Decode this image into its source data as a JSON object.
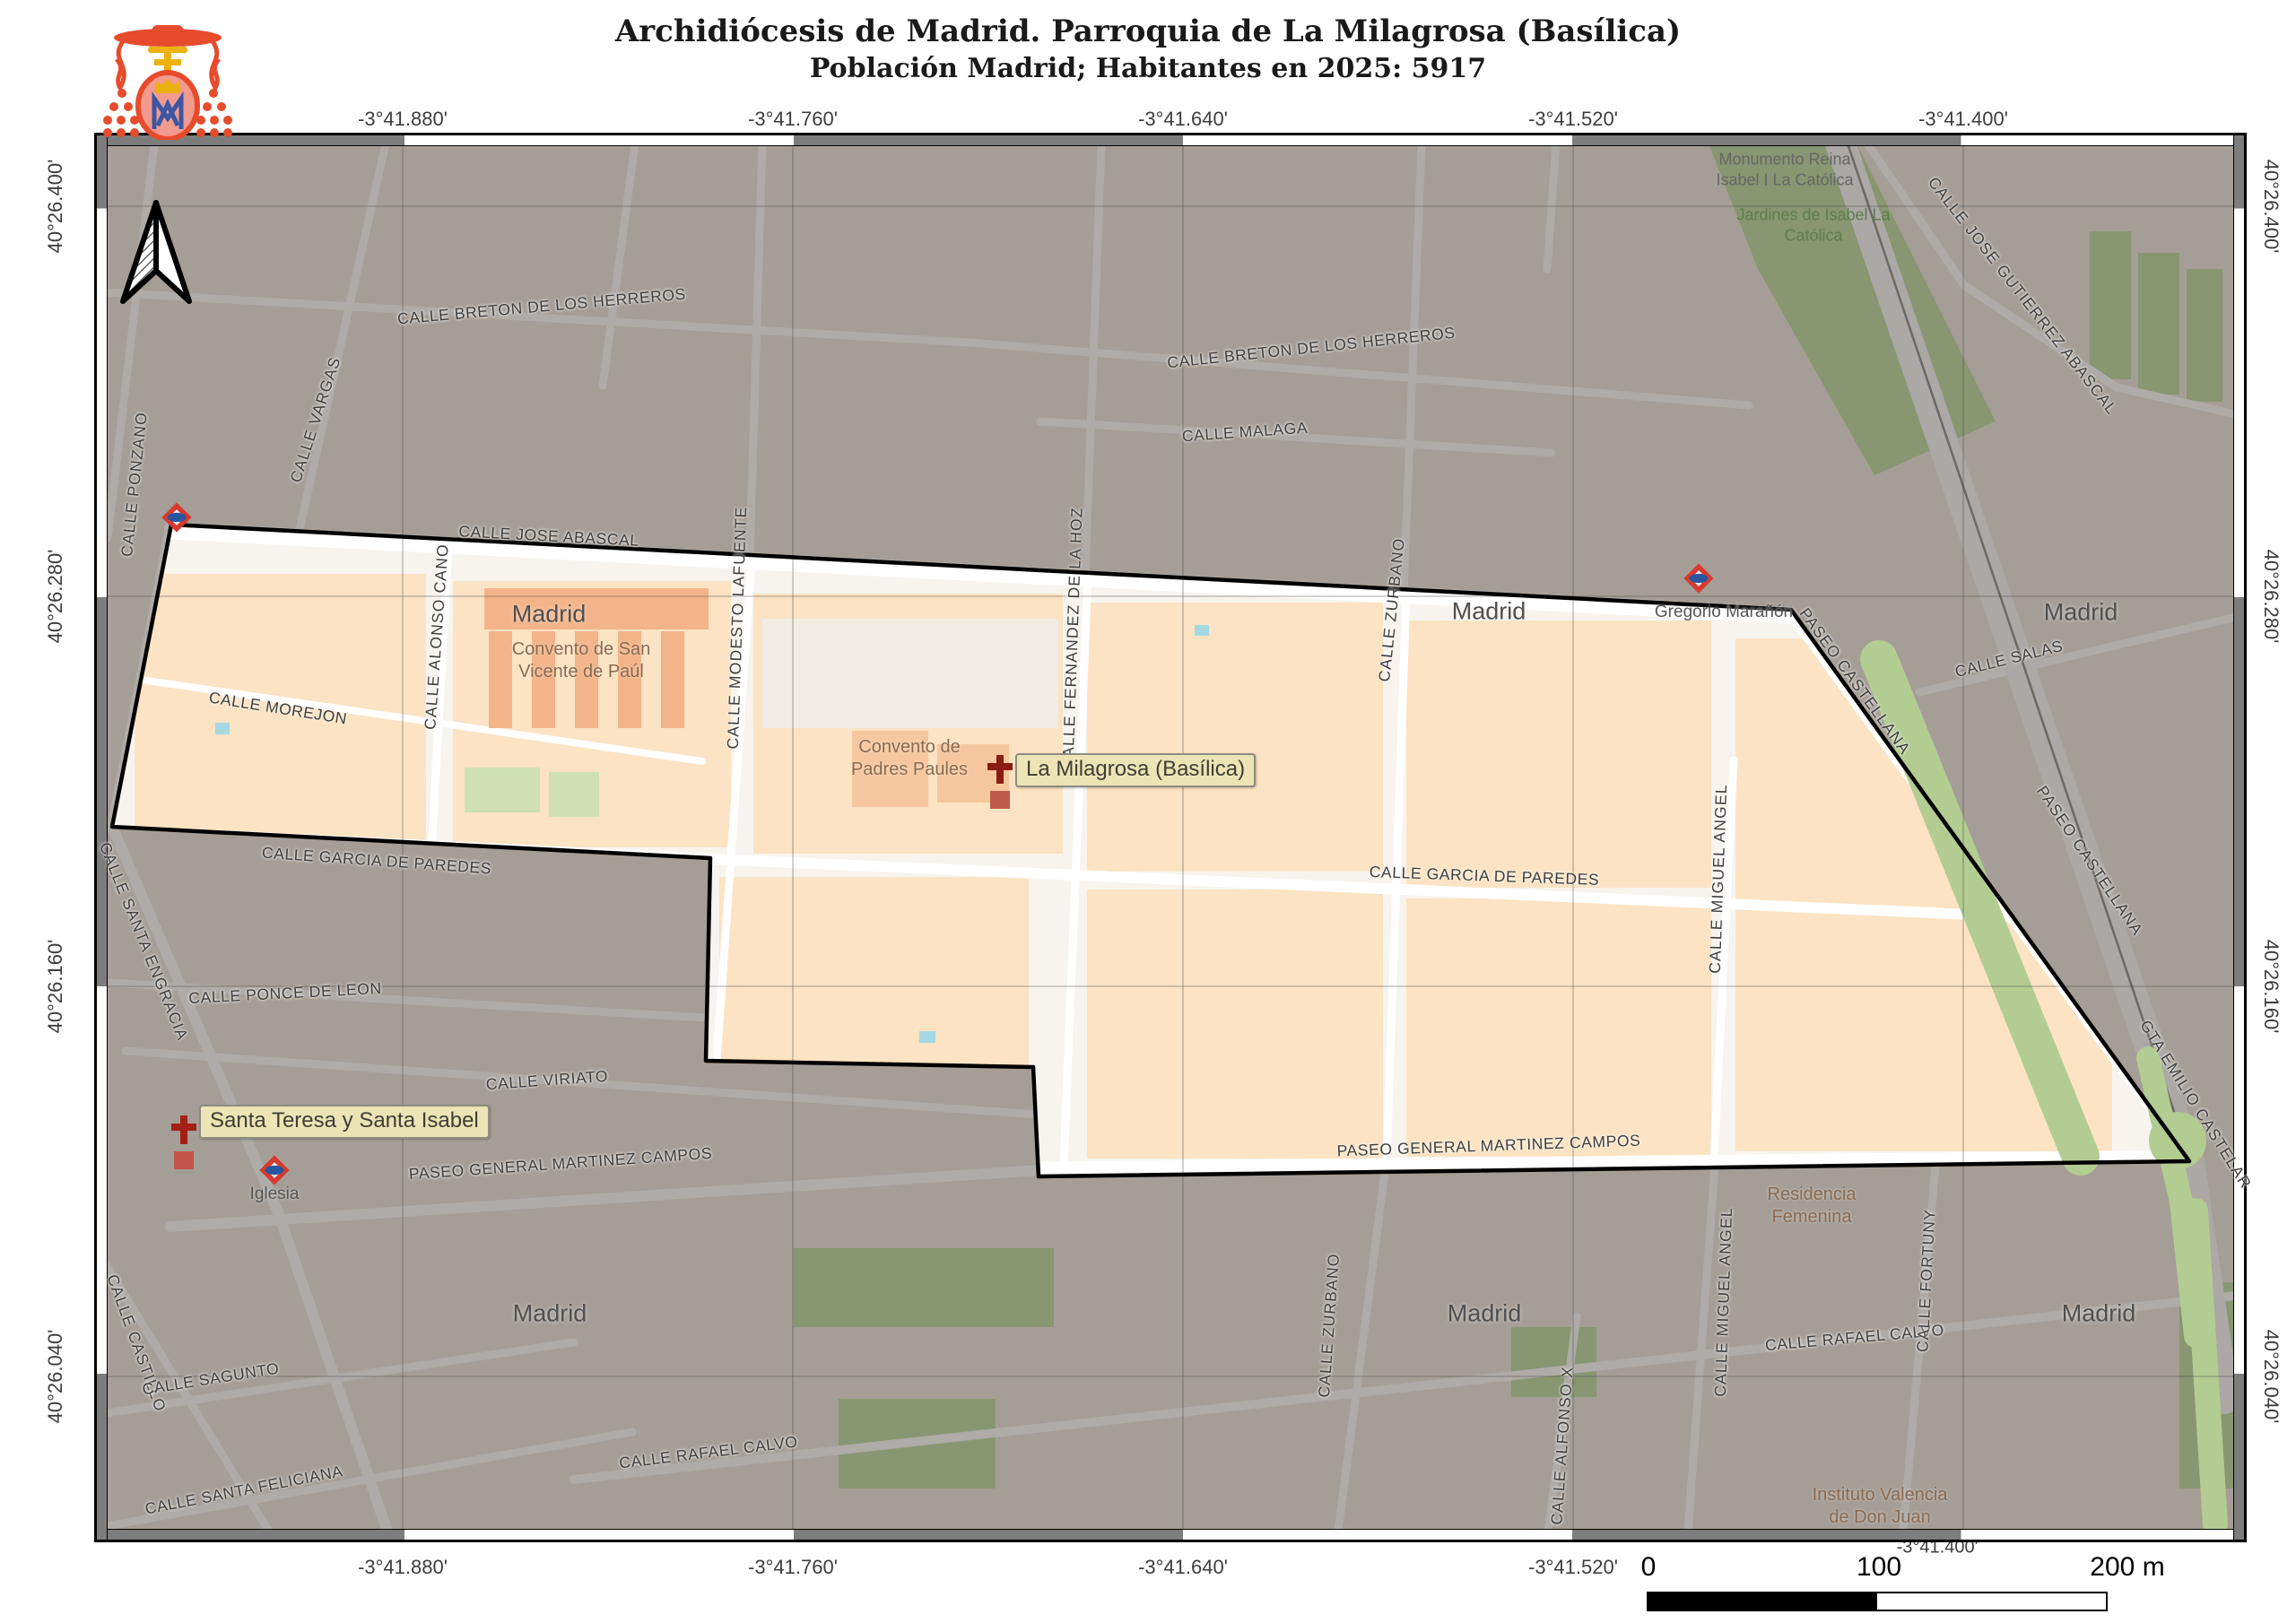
{
  "header": {
    "title": "Archidiócesis de Madrid. Parroquia de La Milagrosa (Basílica)",
    "subtitle": "Población Madrid; Habitantes en 2025: 5917"
  },
  "axes": {
    "top": [
      "-3°41.880'",
      "-3°41.760'",
      "-3°41.640'",
      "-3°41.520'",
      "-3°41.400'"
    ],
    "bottom": [
      "-3°41.880'",
      "-3°41.760'",
      "-3°41.640'",
      "-3°41.520'",
      "-3°41.400'"
    ],
    "left": [
      "40°26.400'",
      "40°26.280'",
      "40°26.160'",
      "40°26.040'"
    ],
    "right": [
      "40°26.400'",
      "40°26.280'",
      "40°26.160'",
      "40°26.040'"
    ]
  },
  "scalebar": {
    "zero": "0",
    "hundred": "100",
    "two_hundred": "200 m"
  },
  "streets": {
    "breton1": "CALLE BRETON DE LOS HERREROS",
    "breton2": "CALLE BRETON DE LOS HERREROS",
    "malaga": "CALLE MALAGA",
    "vargas": "CALLE VARGAS",
    "ponzano": "CALLE PONZANO",
    "jose_abascal": "CALLE JOSE ABASCAL",
    "gutierrez": "CALLE JOSE GUTIERREZ ABASCAL",
    "alonso": "CALLE ALONSO CANO",
    "modesto": "CALLE MODESTO LAFUENTE",
    "fernandez": "CALLE FERNANDEZ DE LA HOZ",
    "zurbano1": "CALLE ZURBANO",
    "zurbano2": "CALLE ZURBANO",
    "miguel1": "CALLE MIGUEL ANGEL",
    "miguel2": "CALLE MIGUEL ANGEL",
    "castellana1": "PASEO CASTELLANA",
    "castellana2": "PASEO CASTELLANA",
    "salas": "CALLE SALAS",
    "morejon": "CALLE MOREJON",
    "garcia1": "CALLE GARCIA DE PAREDES",
    "garcia2": "CALLE GARCIA DE PAREDES",
    "engracia": "CALLE SANTA ENGRACIA",
    "ponce": "CALLE PONCE DE LEON",
    "viriato": "CALLE VIRIATO",
    "martinez1": "PASEO GENERAL MARTINEZ CAMPOS",
    "martinez2": "PASEO GENERAL MARTINEZ CAMPOS",
    "castillo": "CALLE CASTILLO",
    "sagunto": "CALLE SAGUNTO",
    "feliciana": "CALLE SANTA FELICIANA",
    "rafael1": "CALLE RAFAEL CALVO",
    "rafael2": "CALLE RAFAEL CALVO",
    "alfonso_x": "CALLE ALFONSO X",
    "fortuny": "CALLE FORTUNY",
    "gta": "GTA EMILIO CASTELAR"
  },
  "places": {
    "madrid": "Madrid",
    "convento_sv": "Convento de San\nVicente de Paúl",
    "padres": "Convento de\nPadres Paules",
    "monumento": "Monumento Reina\nIsabel I La Católica",
    "jardines": "Jardines de Isabel La\nCatólica",
    "residencia": "Residencia\nFemenina",
    "instituto": "Instituto Valencia\nde Don Juan"
  },
  "stations": {
    "gregorio": "Gregorio Marañón",
    "iglesia": "Iglesia"
  },
  "callouts": {
    "milagrosa": "La Milagrosa (Basílica)",
    "santa_teresa": "Santa Teresa y Santa Isabel"
  },
  "colors": {
    "parish_fill": "#f7f4ef",
    "parish_block": "#fbe3c3",
    "convento": "#f3b489",
    "boundary": "#000000",
    "green": "#b3cc92",
    "metro_red": "#d8392e",
    "metro_blue": "#27569f",
    "church_red": "#8c1c12",
    "callout_bg": "#ece4b4"
  }
}
